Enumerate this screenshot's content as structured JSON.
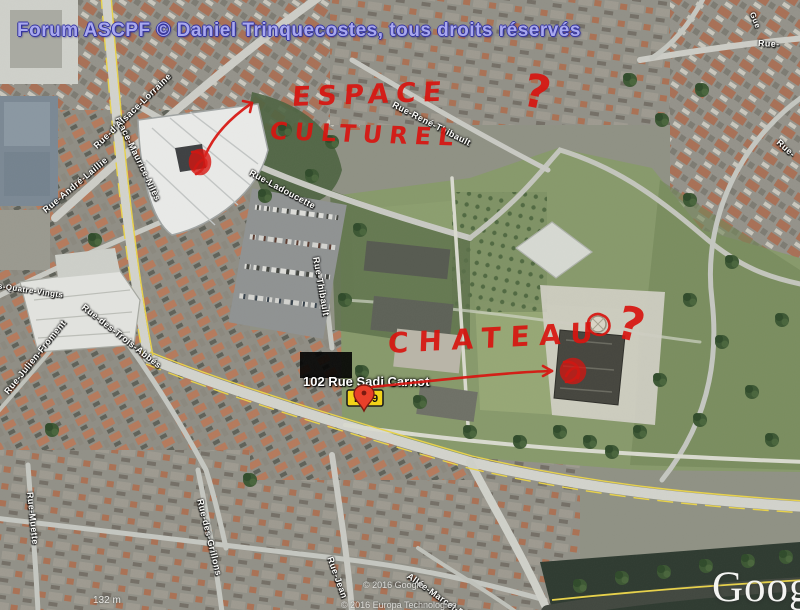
{
  "header": {
    "text": "Forum ASCPF © Daniel Trinquecostes, tous droits réservés",
    "color": "#a9a9ee"
  },
  "annotations": {
    "espace_line1": "ESPACE",
    "espace_line2": "CULTUREL",
    "chateau": "CHATEAU",
    "question_mark_1": "?",
    "question_mark_2": "?",
    "ink_color": "#d81510"
  },
  "address_label": {
    "text": "102 Rue Sadi Carnot"
  },
  "road_shield": {
    "letter": "D",
    "number": "9",
    "shield_color": "#f2d218",
    "pin_color": "#e8402a"
  },
  "streets": [
    {
      "name": "Place-Maurice-Nilès"
    },
    {
      "name": "Rue-d'Alsace-Lorraine"
    },
    {
      "name": "Rue-André-Laillie"
    },
    {
      "name": "Rue-Ladoucette"
    },
    {
      "name": "Rue-René-Thibault"
    },
    {
      "name": "Rue-Thibault"
    },
    {
      "name": "des-Quatre-Vingts"
    },
    {
      "name": "Rue-Julien-Froment"
    },
    {
      "name": "Rue-des-Trois-Abbés"
    },
    {
      "name": "Rue-Muette"
    },
    {
      "name": "Rue-des-Grillons"
    },
    {
      "name": "Rue-Jean"
    },
    {
      "name": "Allée-Marcel-Paul"
    },
    {
      "name": "Rue-"
    },
    {
      "name": "Rue-"
    },
    {
      "name": "Gue"
    }
  ],
  "watermark": {
    "logo": "Google",
    "copyright_1": "© 2016 Google",
    "copyright_2": "© 2016 Europa Technologies",
    "scale_text": "132 m"
  },
  "map_colors": {
    "park_green": "#87996b",
    "road_yellow": "#e8d24a",
    "urban_base": "#96948a",
    "white_building": "#e9eae8"
  }
}
